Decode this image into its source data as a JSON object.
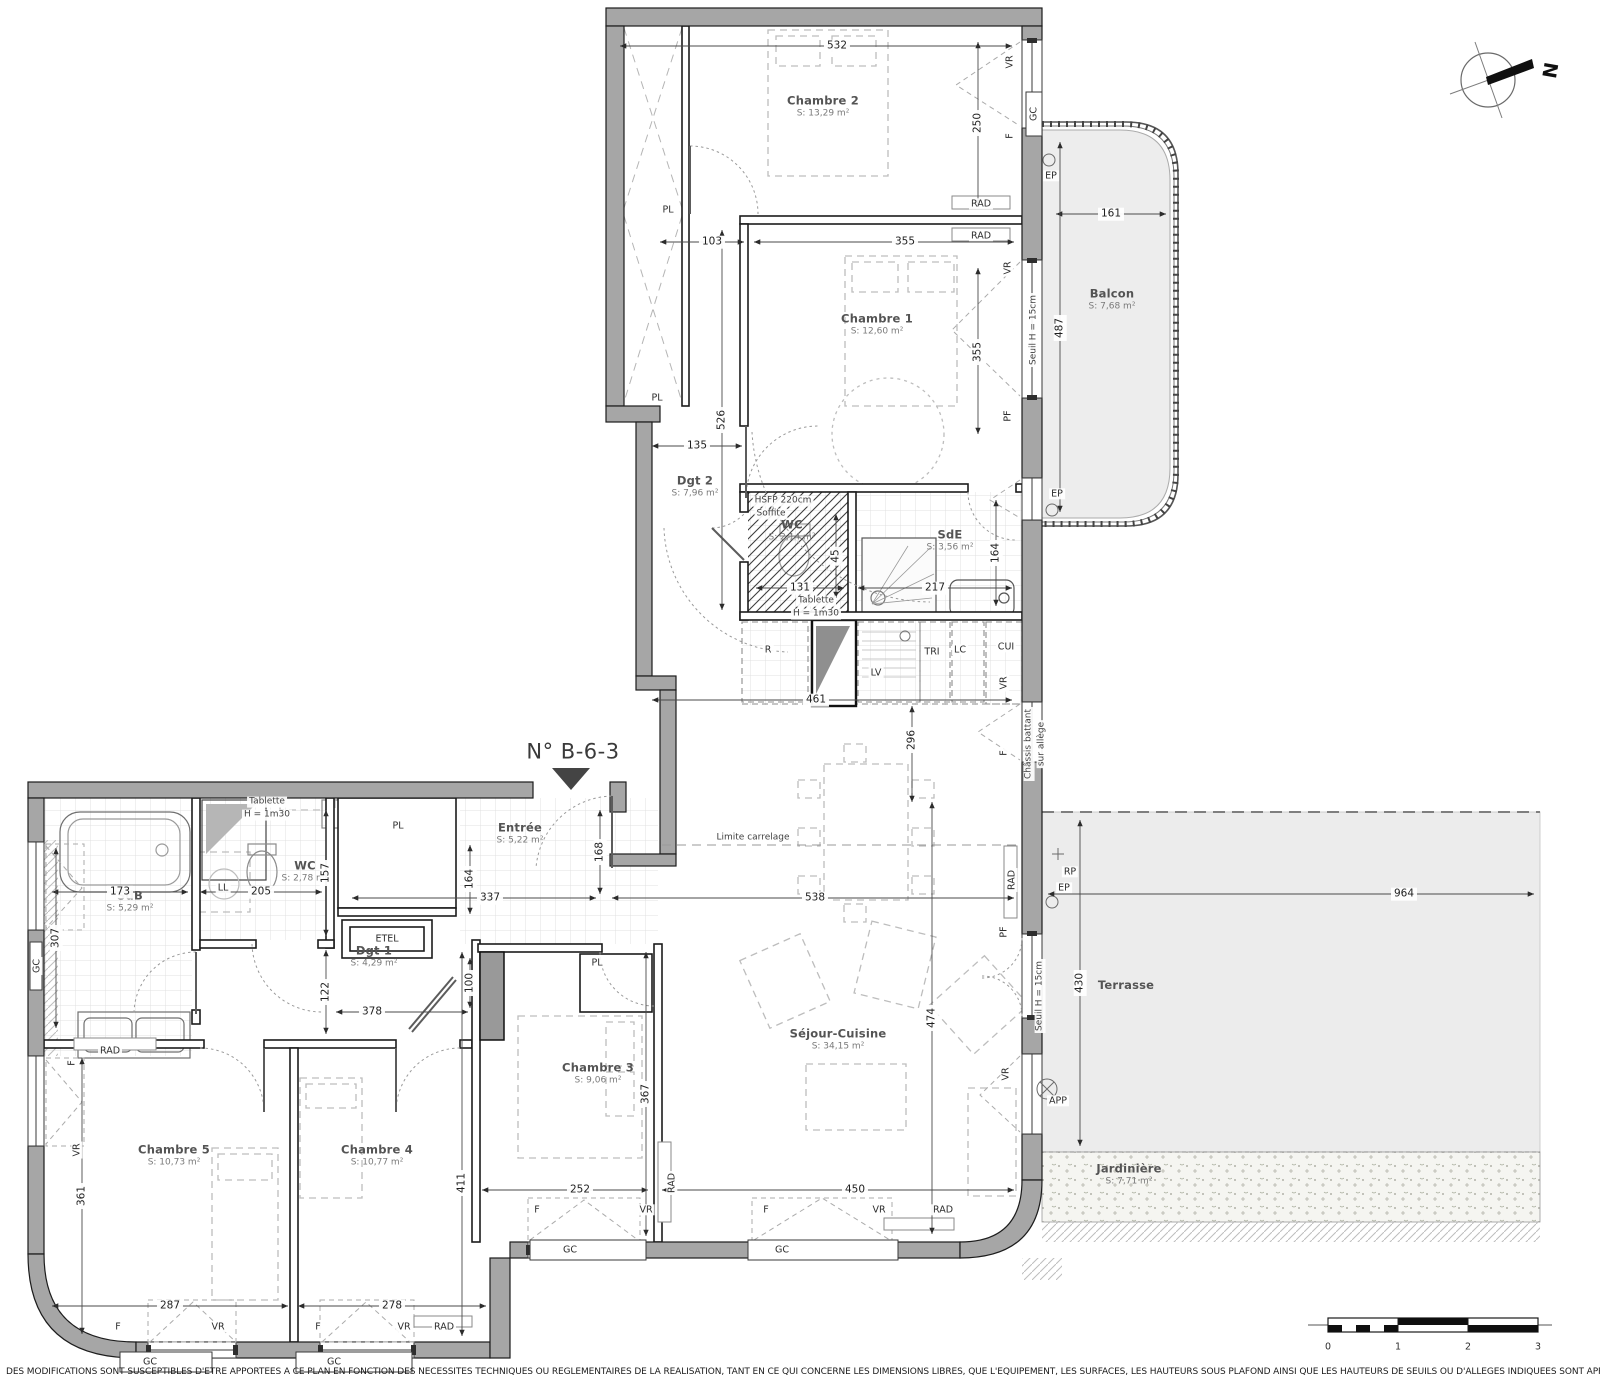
{
  "title": "N° B-6-3",
  "north_label": "N",
  "disclaimer": "DES MODIFICATIONS SONT SUSCEPTIBLES D'ETRE APPORTEES A CE PLAN EN FONCTION DES NECESSITES TECHNIQUES OU REGLEMENTAIRES DE LA REALISATION, TANT EN CE QUI CONCERNE LES DIMENSIONS LIBRES, QUE L'EQUIPEMENT, LES SURFACES, LES HAUTEURS SOUS PLAFOND AINSI QUE LES HAUTEURS DE SEUILS OU D'ALLEGES INDIQUEES SONT APPROXIMATIVES.",
  "rooms": [
    {
      "name": "Chambre 2",
      "area": "S: 13,29 m²",
      "x": 823,
      "y": 107
    },
    {
      "name": "Chambre 1",
      "area": "S: 12,60 m²",
      "x": 877,
      "y": 325
    },
    {
      "name": "Balcon",
      "area": "S: 7,68 m²",
      "x": 1112,
      "y": 300
    },
    {
      "name": "Dgt 2",
      "area": "S: 7,96 m²",
      "x": 695,
      "y": 487
    },
    {
      "name": "WC",
      "area": "S: 2,14 m²",
      "x": 792,
      "y": 531
    },
    {
      "name": "SdE",
      "area": "S: 3,56 m²",
      "x": 950,
      "y": 541
    },
    {
      "name": "Entrée",
      "area": "S: 5,22 m²",
      "x": 520,
      "y": 834
    },
    {
      "name": "WC",
      "area": "S: 2,78 m²",
      "x": 305,
      "y": 872
    },
    {
      "name": "SdB",
      "area": "S: 5,29 m²",
      "x": 130,
      "y": 902
    },
    {
      "name": "Dgt 1",
      "area": "S: 4,29 m²",
      "x": 374,
      "y": 957
    },
    {
      "name": "Chambre 3",
      "area": "S: 9,06 m²",
      "x": 598,
      "y": 1074
    },
    {
      "name": "Séjour-Cuisine",
      "area": "S: 34,15 m²",
      "x": 838,
      "y": 1040
    },
    {
      "name": "Chambre 5",
      "area": "S: 10,73 m²",
      "x": 174,
      "y": 1156
    },
    {
      "name": "Chambre 4",
      "area": "S: 10,77 m²",
      "x": 377,
      "y": 1156
    },
    {
      "name": "Terrasse",
      "area": "",
      "x": 1126,
      "y": 986
    },
    {
      "name": "Jardinière",
      "area": "S: 7,71 m²",
      "x": 1129,
      "y": 1175
    }
  ],
  "dims": [
    {
      "t": "532",
      "x": 837,
      "y": 46
    },
    {
      "t": "250",
      "x": 978,
      "y": 123,
      "rot": 1
    },
    {
      "t": "103",
      "x": 712,
      "y": 242
    },
    {
      "t": "355",
      "x": 905,
      "y": 242
    },
    {
      "t": "355",
      "x": 978,
      "y": 352,
      "rot": 1
    },
    {
      "t": "526",
      "x": 722,
      "y": 420,
      "rot": 1
    },
    {
      "t": "135",
      "x": 697,
      "y": 446
    },
    {
      "t": "161",
      "x": 1111,
      "y": 214
    },
    {
      "t": "487",
      "x": 1060,
      "y": 328,
      "rot": 1
    },
    {
      "t": "131",
      "x": 800,
      "y": 588
    },
    {
      "t": "217",
      "x": 935,
      "y": 588
    },
    {
      "t": "164",
      "x": 996,
      "y": 553,
      "rot": 1
    },
    {
      "t": "45",
      "x": 836,
      "y": 556,
      "rot": 1
    },
    {
      "t": "461",
      "x": 816,
      "y": 700
    },
    {
      "t": "296",
      "x": 912,
      "y": 740,
      "rot": 1
    },
    {
      "t": "538",
      "x": 815,
      "y": 898
    },
    {
      "t": "168",
      "x": 600,
      "y": 852,
      "rot": 1
    },
    {
      "t": "337",
      "x": 490,
      "y": 898
    },
    {
      "t": "164",
      "x": 470,
      "y": 879,
      "rot": 1
    },
    {
      "t": "100",
      "x": 470,
      "y": 983,
      "rot": 1
    },
    {
      "t": "173",
      "x": 120,
      "y": 892
    },
    {
      "t": "205",
      "x": 261,
      "y": 892
    },
    {
      "t": "307",
      "x": 56,
      "y": 938,
      "rot": 1
    },
    {
      "t": "157",
      "x": 326,
      "y": 873,
      "rot": 1
    },
    {
      "t": "122",
      "x": 326,
      "y": 992,
      "rot": 1
    },
    {
      "t": "378",
      "x": 372,
      "y": 1012
    },
    {
      "t": "361",
      "x": 82,
      "y": 1196,
      "rot": 1
    },
    {
      "t": "287",
      "x": 170,
      "y": 1306
    },
    {
      "t": "278",
      "x": 392,
      "y": 1306
    },
    {
      "t": "411",
      "x": 462,
      "y": 1183,
      "rot": 1
    },
    {
      "t": "252",
      "x": 580,
      "y": 1190
    },
    {
      "t": "450",
      "x": 855,
      "y": 1190
    },
    {
      "t": "367",
      "x": 646,
      "y": 1094,
      "rot": 1
    },
    {
      "t": "474",
      "x": 932,
      "y": 1018,
      "rot": 1
    },
    {
      "t": "964",
      "x": 1404,
      "y": 894
    },
    {
      "t": "430",
      "x": 1080,
      "y": 983,
      "rot": 1
    }
  ],
  "tags": [
    {
      "t": "VR",
      "x": 1010,
      "y": 62,
      "rot": 1
    },
    {
      "t": "F",
      "x": 1010,
      "y": 136,
      "rot": 1
    },
    {
      "t": "GC",
      "x": 1034,
      "y": 114,
      "rot": 1
    },
    {
      "t": "RAD",
      "x": 981,
      "y": 204
    },
    {
      "t": "RAD",
      "x": 981,
      "y": 236
    },
    {
      "t": "VR",
      "x": 1008,
      "y": 268,
      "rot": 1
    },
    {
      "t": "PF",
      "x": 1008,
      "y": 416,
      "rot": 1
    },
    {
      "t": "EP",
      "x": 1051,
      "y": 176
    },
    {
      "t": "EP",
      "x": 1057,
      "y": 494
    },
    {
      "t": "PL",
      "x": 668,
      "y": 210
    },
    {
      "t": "PL",
      "x": 657,
      "y": 398
    },
    {
      "t": "R",
      "x": 768,
      "y": 650
    },
    {
      "t": "LV",
      "x": 876,
      "y": 673
    },
    {
      "t": "TRI",
      "x": 932,
      "y": 652
    },
    {
      "t": "LC",
      "x": 960,
      "y": 650
    },
    {
      "t": "CUI",
      "x": 1006,
      "y": 647
    },
    {
      "t": "VR",
      "x": 1004,
      "y": 683,
      "rot": 1
    },
    {
      "t": "F",
      "x": 1004,
      "y": 753,
      "rot": 1
    },
    {
      "t": "PF",
      "x": 1004,
      "y": 932,
      "rot": 1
    },
    {
      "t": "RAD",
      "x": 1012,
      "y": 880,
      "rot": 1
    },
    {
      "t": "RP",
      "x": 1070,
      "y": 872
    },
    {
      "t": "EP",
      "x": 1064,
      "y": 888
    },
    {
      "t": "VR",
      "x": 1006,
      "y": 1074,
      "rot": 1
    },
    {
      "t": "APP",
      "x": 1058,
      "y": 1101
    },
    {
      "t": "GC",
      "x": 37,
      "y": 966,
      "rot": 1
    },
    {
      "t": "F",
      "x": 72,
      "y": 1063,
      "rot": 1
    },
    {
      "t": "VR",
      "x": 77,
      "y": 1150,
      "rot": 1
    },
    {
      "t": "LL",
      "x": 223,
      "y": 888
    },
    {
      "t": "ETEL",
      "x": 387,
      "y": 939
    },
    {
      "t": "RAD",
      "x": 110,
      "y": 1051
    },
    {
      "t": "PL",
      "x": 398,
      "y": 826
    },
    {
      "t": "PL",
      "x": 597,
      "y": 963
    },
    {
      "t": "RAD",
      "x": 672,
      "y": 1183,
      "rot": 1
    },
    {
      "t": "RAD",
      "x": 943,
      "y": 1210
    },
    {
      "t": "F",
      "x": 537,
      "y": 1210
    },
    {
      "t": "VR",
      "x": 646,
      "y": 1210
    },
    {
      "t": "F",
      "x": 766,
      "y": 1210
    },
    {
      "t": "VR",
      "x": 879,
      "y": 1210
    },
    {
      "t": "GC",
      "x": 570,
      "y": 1250
    },
    {
      "t": "GC",
      "x": 782,
      "y": 1250
    },
    {
      "t": "F",
      "x": 118,
      "y": 1327
    },
    {
      "t": "VR",
      "x": 218,
      "y": 1327
    },
    {
      "t": "F",
      "x": 318,
      "y": 1327
    },
    {
      "t": "VR",
      "x": 404,
      "y": 1327
    },
    {
      "t": "RAD",
      "x": 444,
      "y": 1327
    },
    {
      "t": "GC",
      "x": 150,
      "y": 1362
    },
    {
      "t": "GC",
      "x": 334,
      "y": 1362
    },
    {
      "t": "0",
      "x": 1328,
      "y": 1347
    },
    {
      "t": "1",
      "x": 1398,
      "y": 1347
    },
    {
      "t": "2",
      "x": 1468,
      "y": 1347
    },
    {
      "t": "3",
      "x": 1538,
      "y": 1347
    }
  ],
  "notes": [
    {
      "t": "Tablette",
      "x": 816,
      "y": 601
    },
    {
      "t": "H = 1m30",
      "x": 816,
      "y": 614
    },
    {
      "t": "HSFP 220cm",
      "x": 783,
      "y": 501
    },
    {
      "t": "Soffite",
      "x": 771,
      "y": 514
    },
    {
      "t": "Tablette",
      "x": 267,
      "y": 802
    },
    {
      "t": "H = 1m30",
      "x": 267,
      "y": 815
    },
    {
      "t": "Limite carrelage",
      "x": 753,
      "y": 838
    },
    {
      "t": "Seuil H = 15cm",
      "x": 1034,
      "y": 330,
      "rot": 1
    },
    {
      "t": "Seuil H = 15cm",
      "x": 1040,
      "y": 996,
      "rot": 1
    },
    {
      "t": "Châssis battant",
      "x": 1029,
      "y": 744,
      "rot": 1
    },
    {
      "t": "sur allège",
      "x": 1042,
      "y": 744,
      "rot": 1
    }
  ]
}
